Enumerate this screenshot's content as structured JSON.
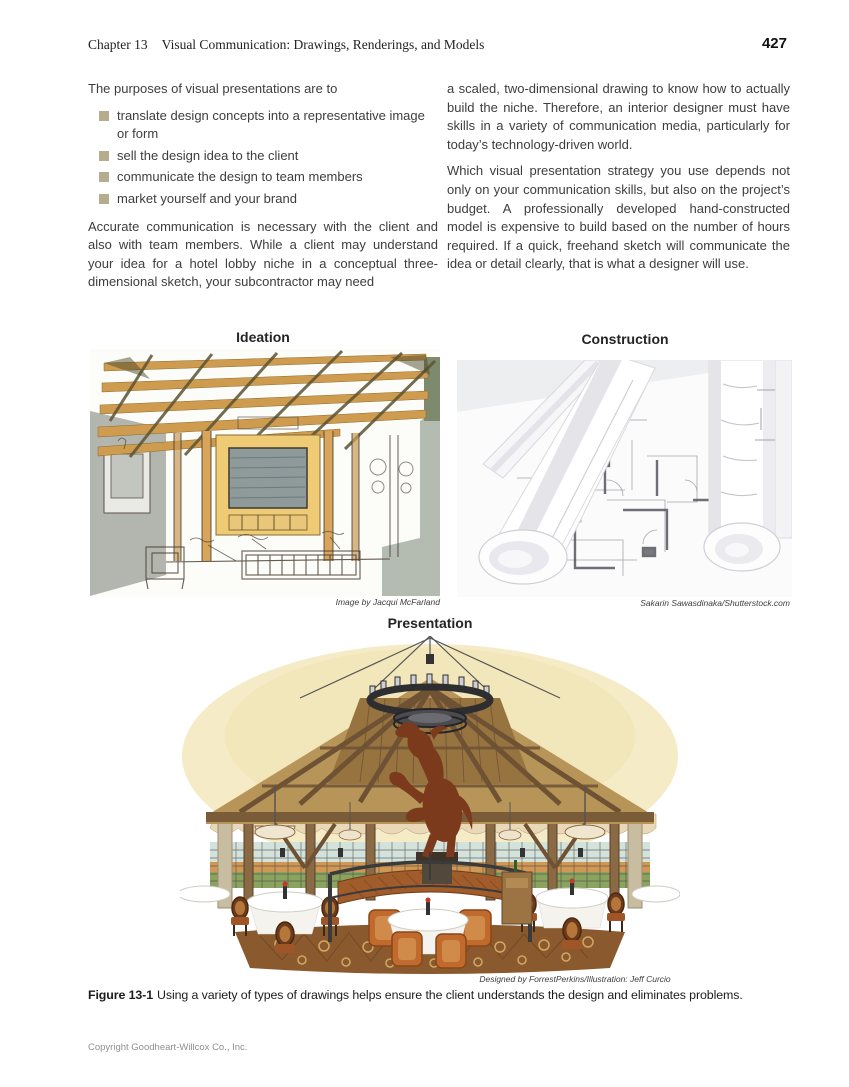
{
  "header": {
    "chapter": "Chapter 13",
    "title": "Visual Communication: Drawings, Renderings, and Models",
    "page_number": "427"
  },
  "body": {
    "intro": "The purposes of visual presentations are to",
    "bullets": [
      "translate design concepts into a representative image or form",
      "sell the design idea to the client",
      "communicate the design to team members",
      "market yourself and your brand"
    ],
    "left_paragraph": "Accurate communication is necessary with the client and also with team members. While a client may understand your idea for a hotel lobby niche in a conceptual three-dimensional sketch, your subcontractor may need",
    "right_paragraph_1": "a scaled, two-dimensional drawing to know how to actually build the niche. Therefore, an interior designer must have skills in a variety of communication media, particularly for today’s technology-driven world.",
    "right_paragraph_2": "Which visual presentation strategy you use depends not only on your communication skills, but also on the project’s budget. A professionally developed hand-constructed model is expensive to build based on the number of hours required. If a quick, freehand sketch will communicate the idea or detail clearly, that is what a designer will use."
  },
  "figure": {
    "ideation_label": "Ideation",
    "construction_label": "Construction",
    "presentation_label": "Presentation",
    "ideation_credit": "Image by Jacqui McFarland",
    "construction_credit": "Sakarin Sawasdinaka/Shutterstock.com",
    "presentation_credit": "Designed by ForrestPerkins/Illustration: Jeff Curcio",
    "caption_label": "Figure 13-1",
    "caption_text": "Using a variety of types of drawings helps ensure the client understands the design and eliminates problems."
  },
  "footer": {
    "copyright": "Copyright Goodheart-Willcox Co., Inc."
  },
  "colors": {
    "bullet_square": "#b5ad8e",
    "body_text": "#3d3d3d",
    "footer_text": "#8f8f8f",
    "sketch_beam_tan": "#cf9b4e",
    "sketch_frame_gold": "#eecb74",
    "rendering_roof_wood": "#a8874e",
    "rendering_horse_brown": "#7c3a1d",
    "rendering_chair_orange": "#c06b2d",
    "rendering_carpet_brown": "#8a5a2e"
  }
}
